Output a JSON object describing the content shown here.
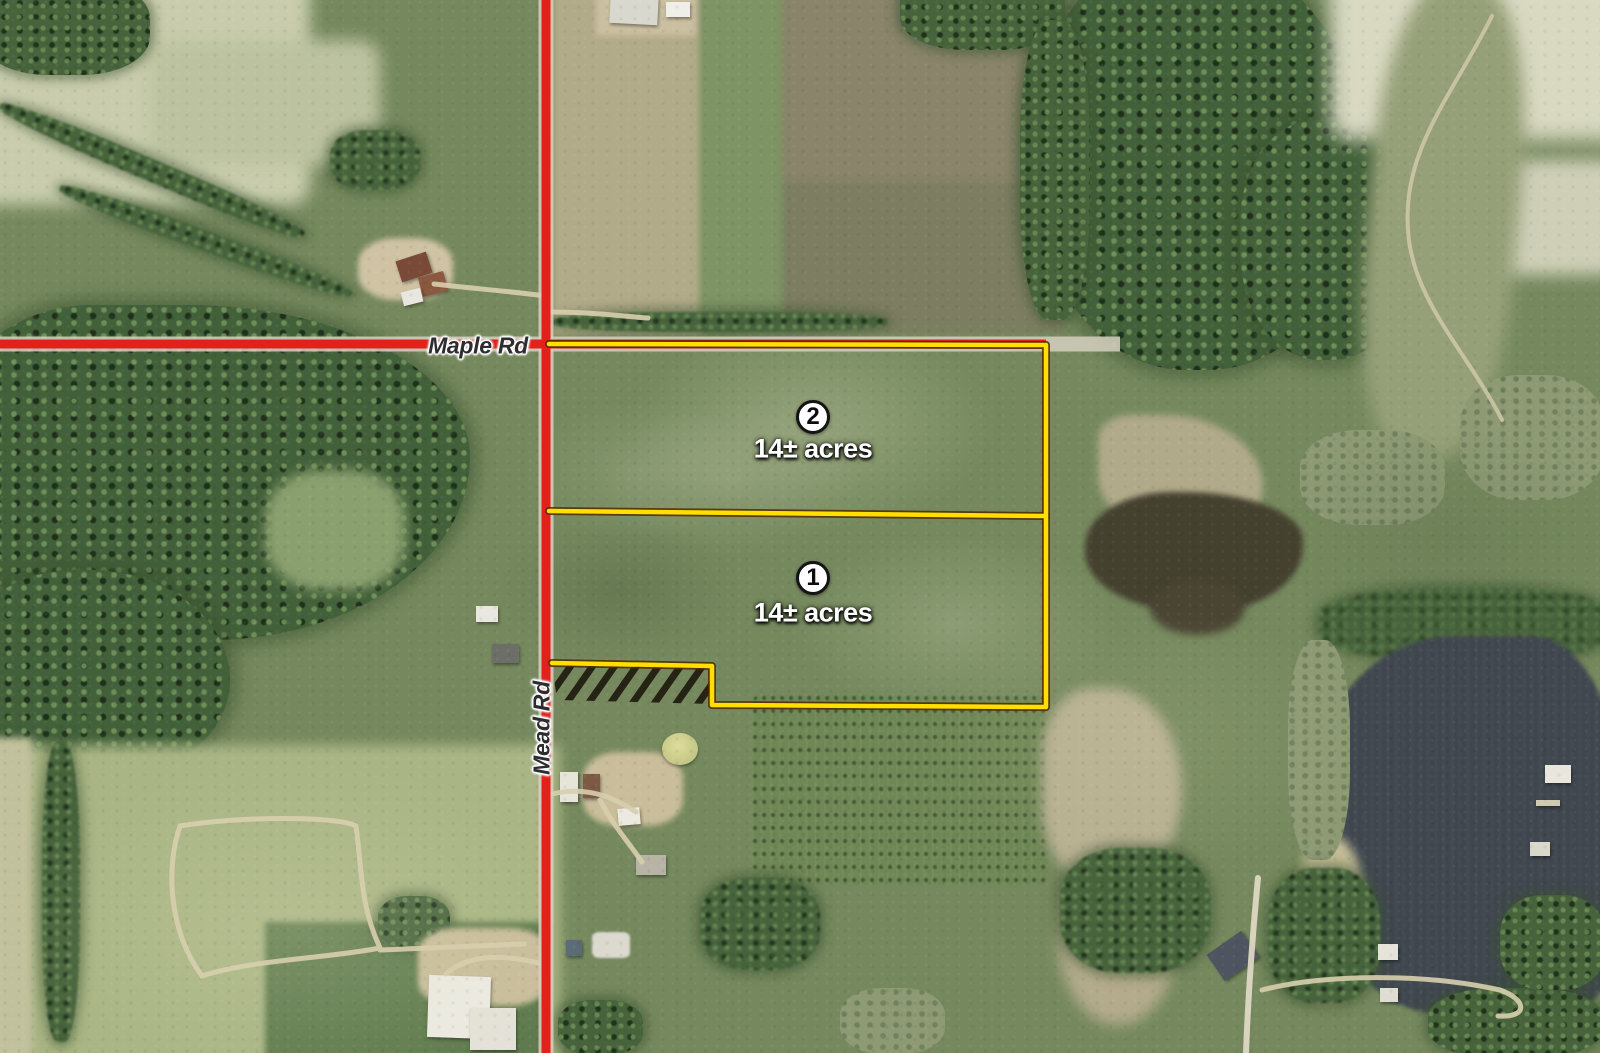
{
  "roads": {
    "maple": {
      "label": "Maple Rd"
    },
    "mead": {
      "label": "Mead Rd"
    }
  },
  "parcels": [
    {
      "number": "2",
      "acres": "14± acres"
    },
    {
      "number": "1",
      "acres": "14± acres"
    }
  ],
  "colors": {
    "road": "#e2211b",
    "road_base": "#d6d0c0",
    "boundary": "#ffdf00",
    "boundary_shadow": "rgba(82,41,0,0.85)",
    "hatch": "rgba(20,14,4,0.82)",
    "label_text": "#2d2d30",
    "acres_text": "#ffffff"
  }
}
